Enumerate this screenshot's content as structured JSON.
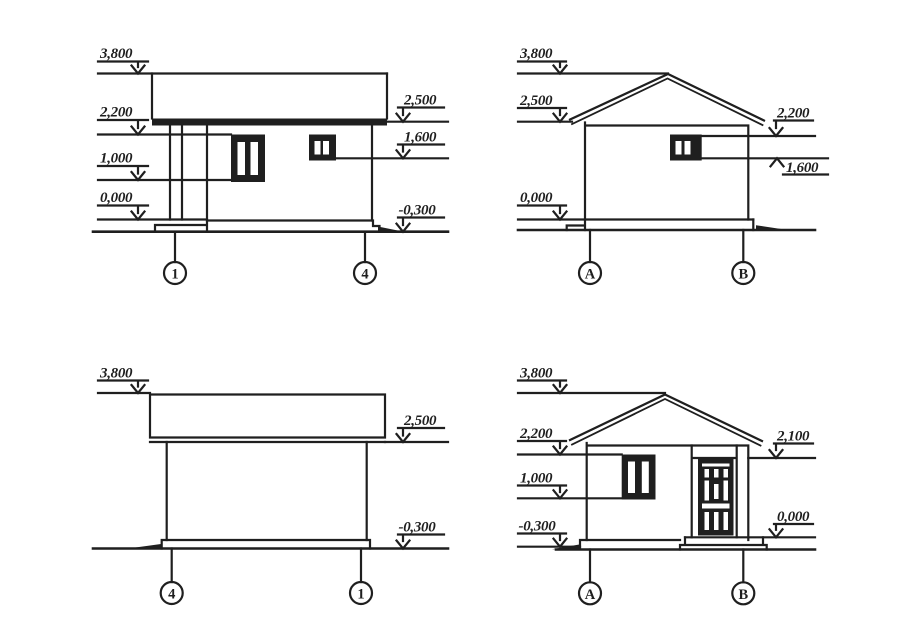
{
  "page": {
    "background": "#ffffff",
    "ink": "#1f1f1f"
  },
  "elevations": {
    "top_left": {
      "axis_left": "1",
      "axis_right": "4",
      "levels_left": {
        "l1": "3,800",
        "l2": "2,200",
        "l3": "1,000",
        "l4": "0,000"
      },
      "levels_right": {
        "r1": "2,500",
        "r2": "1,600",
        "r3": "-0,300"
      }
    },
    "top_right": {
      "axis_left": "A",
      "axis_right": "B",
      "levels_left": {
        "l1": "3,800",
        "l2": "2,500",
        "l3": "0,000"
      },
      "levels_right": {
        "r1": "2,200",
        "r2": "1,600"
      }
    },
    "bottom_left": {
      "axis_left": "4",
      "axis_right": "1",
      "levels_left": {
        "l1": "3,800"
      },
      "levels_right": {
        "r1": "2,500",
        "r2": "-0,300"
      }
    },
    "bottom_right": {
      "axis_left": "A",
      "axis_right": "B",
      "levels_left": {
        "l1": "3,800",
        "l2": "2,200",
        "l3": "1,000",
        "l4": "-0,300"
      },
      "levels_right": {
        "r1": "2,100",
        "r2": "0,000"
      }
    }
  }
}
